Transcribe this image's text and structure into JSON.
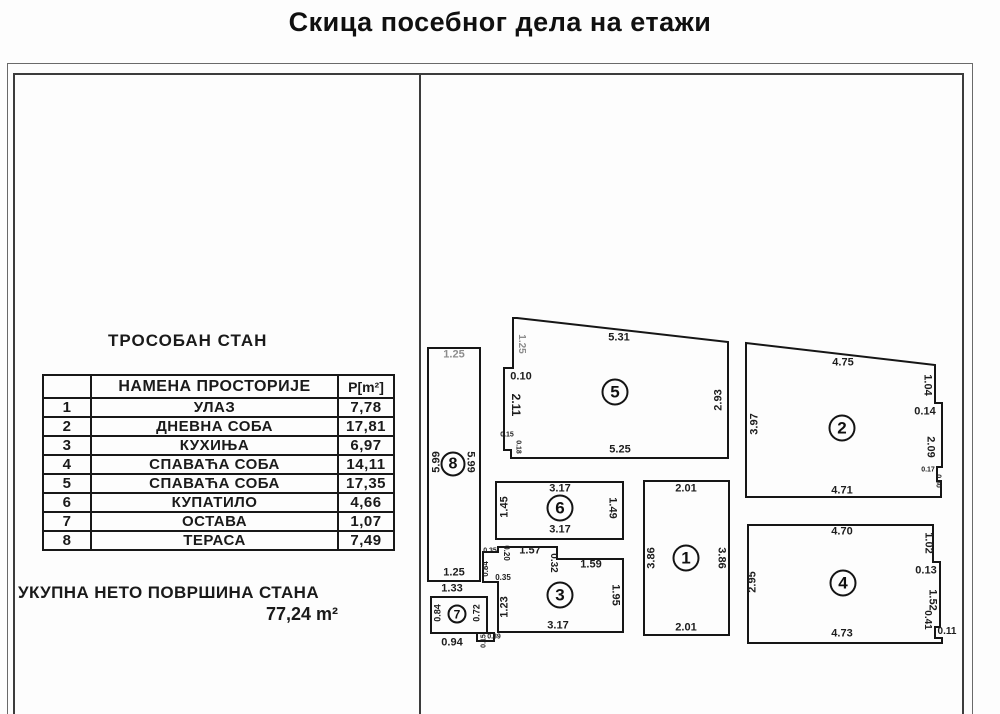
{
  "title": "Скица посебног дела на етажи",
  "left_panel": {
    "apartment_type": "ТРОСОБАН СТАН",
    "table": {
      "header_no": "",
      "header_purpose": "НАМЕНА ПРОСТОРИЈЕ",
      "header_area": "P[m²]",
      "rows": [
        {
          "no": "1",
          "name": "УЛАЗ",
          "area": "7,78"
        },
        {
          "no": "2",
          "name": "ДНЕВНА СОБА",
          "area": "17,81"
        },
        {
          "no": "3",
          "name": "КУХИЊА",
          "area": "6,97"
        },
        {
          "no": "4",
          "name": "СПАВАЋА СОБА",
          "area": "14,11"
        },
        {
          "no": "5",
          "name": "СПАВАЋА СОБА",
          "area": "17,35"
        },
        {
          "no": "6",
          "name": "КУПАТИЛО",
          "area": "4,66"
        },
        {
          "no": "7",
          "name": "ОСТАВА",
          "area": "1,07"
        },
        {
          "no": "8",
          "name": "ТЕРАСА",
          "area": "7,49"
        }
      ]
    },
    "total_label": "УКУПНА НЕТО ПОВРШИНА СТАНА",
    "total_value": "77,24 m²"
  },
  "plan": {
    "line_color": "#161616",
    "faded_label_color": "#8d8d8d",
    "room_markers": [
      {
        "n": "1",
        "x": 686,
        "y": 558,
        "d": 27
      },
      {
        "n": "2",
        "x": 842,
        "y": 428,
        "d": 27
      },
      {
        "n": "3",
        "x": 560,
        "y": 595,
        "d": 27
      },
      {
        "n": "4",
        "x": 843,
        "y": 583,
        "d": 27
      },
      {
        "n": "5",
        "x": 615,
        "y": 392,
        "d": 27
      },
      {
        "n": "6",
        "x": 560,
        "y": 508,
        "d": 27
      },
      {
        "n": "7",
        "x": 457,
        "y": 614,
        "d": 19
      },
      {
        "n": "8",
        "x": 453,
        "y": 464,
        "d": 25
      }
    ],
    "dimension_labels": [
      {
        "t": "1.25",
        "x": 454,
        "y": 355,
        "r": 0,
        "s": 11,
        "c": "faded"
      },
      {
        "t": "5.99",
        "x": 437,
        "y": 462,
        "r": -90,
        "s": 11
      },
      {
        "t": "5.99",
        "x": 470,
        "y": 462,
        "r": 90,
        "s": 11
      },
      {
        "t": "1.25",
        "x": 454,
        "y": 573,
        "r": 0,
        "s": 11
      },
      {
        "t": "1.33",
        "x": 452,
        "y": 589,
        "r": 0,
        "s": 11
      },
      {
        "t": "0.84",
        "x": 438,
        "y": 613,
        "r": -90,
        "s": 9
      },
      {
        "t": "0.72",
        "x": 477,
        "y": 613,
        "r": -90,
        "s": 9
      },
      {
        "t": "0.94",
        "x": 452,
        "y": 643,
        "r": 0,
        "s": 11
      },
      {
        "t": "0.15",
        "x": 484,
        "y": 641,
        "r": -90,
        "s": 7
      },
      {
        "t": "0.39",
        "x": 494,
        "y": 637,
        "r": 0,
        "s": 7
      },
      {
        "t": "3.17",
        "x": 560,
        "y": 489,
        "r": 0,
        "s": 11
      },
      {
        "t": "1.45",
        "x": 505,
        "y": 507,
        "r": -90,
        "s": 11
      },
      {
        "t": "1.49",
        "x": 612,
        "y": 508,
        "r": 90,
        "s": 11
      },
      {
        "t": "3.17",
        "x": 560,
        "y": 530,
        "r": 0,
        "s": 11
      },
      {
        "t": "0.35",
        "x": 490,
        "y": 551,
        "r": 0,
        "s": 7
      },
      {
        "t": "0.20",
        "x": 506,
        "y": 553,
        "r": 90,
        "s": 8
      },
      {
        "t": "1.57",
        "x": 530,
        "y": 551,
        "r": 0,
        "s": 11
      },
      {
        "t": "0.32",
        "x": 553,
        "y": 563,
        "r": 90,
        "s": 10
      },
      {
        "t": "1.59",
        "x": 591,
        "y": 565,
        "r": 0,
        "s": 11
      },
      {
        "t": "0.84",
        "x": 486,
        "y": 569,
        "r": -90,
        "s": 8
      },
      {
        "t": "0.35",
        "x": 503,
        "y": 578,
        "r": 0,
        "s": 8
      },
      {
        "t": "1.23",
        "x": 505,
        "y": 607,
        "r": -90,
        "s": 11
      },
      {
        "t": "1.95",
        "x": 615,
        "y": 595,
        "r": 90,
        "s": 11
      },
      {
        "t": "3.17",
        "x": 558,
        "y": 626,
        "r": 0,
        "s": 11
      },
      {
        "t": "2.01",
        "x": 686,
        "y": 489,
        "r": 0,
        "s": 11
      },
      {
        "t": "3.86",
        "x": 652,
        "y": 558,
        "r": -90,
        "s": 11
      },
      {
        "t": "3.86",
        "x": 721,
        "y": 558,
        "r": 90,
        "s": 11
      },
      {
        "t": "2.01",
        "x": 686,
        "y": 628,
        "r": 0,
        "s": 11
      },
      {
        "t": "1.25",
        "x": 521,
        "y": 344,
        "r": 90,
        "s": 10,
        "c": "faded"
      },
      {
        "t": "5.31",
        "x": 619,
        "y": 338,
        "r": 0,
        "s": 11
      },
      {
        "t": "0.10",
        "x": 521,
        "y": 377,
        "r": 0,
        "s": 11
      },
      {
        "t": "2.11",
        "x": 516,
        "y": 405,
        "r": 90,
        "s": 12
      },
      {
        "t": "0.15",
        "x": 507,
        "y": 435,
        "r": 0,
        "s": 7
      },
      {
        "t": "0.18",
        "x": 518,
        "y": 447,
        "r": 90,
        "s": 7
      },
      {
        "t": "5.25",
        "x": 620,
        "y": 450,
        "r": 0,
        "s": 11
      },
      {
        "t": "2.93",
        "x": 719,
        "y": 400,
        "r": -90,
        "s": 11
      },
      {
        "t": "4.75",
        "x": 843,
        "y": 363,
        "r": 0,
        "s": 11
      },
      {
        "t": "3.97",
        "x": 755,
        "y": 424,
        "r": -90,
        "s": 11
      },
      {
        "t": "1.04",
        "x": 927,
        "y": 385,
        "r": 90,
        "s": 11
      },
      {
        "t": "0.14",
        "x": 925,
        "y": 412,
        "r": 0,
        "s": 11
      },
      {
        "t": "2.09",
        "x": 930,
        "y": 447,
        "r": 90,
        "s": 11
      },
      {
        "t": "0.17",
        "x": 928,
        "y": 470,
        "r": 0,
        "s": 7
      },
      {
        "t": "0.30",
        "x": 938,
        "y": 481,
        "r": 90,
        "s": 7
      },
      {
        "t": "4.71",
        "x": 842,
        "y": 491,
        "r": 0,
        "s": 11
      },
      {
        "t": "4.70",
        "x": 842,
        "y": 532,
        "r": 0,
        "s": 11
      },
      {
        "t": "2.95",
        "x": 753,
        "y": 582,
        "r": -90,
        "s": 11
      },
      {
        "t": "1.02",
        "x": 928,
        "y": 543,
        "r": 90,
        "s": 11
      },
      {
        "t": "0.13",
        "x": 926,
        "y": 571,
        "r": 0,
        "s": 11
      },
      {
        "t": "1.52",
        "x": 932,
        "y": 600,
        "r": 90,
        "s": 11
      },
      {
        "t": "0.41",
        "x": 927,
        "y": 620,
        "r": 90,
        "s": 10
      },
      {
        "t": "0.11",
        "x": 947,
        "y": 632,
        "r": 0,
        "s": 10
      },
      {
        "t": "4.73",
        "x": 842,
        "y": 634,
        "r": 0,
        "s": 11
      }
    ]
  }
}
